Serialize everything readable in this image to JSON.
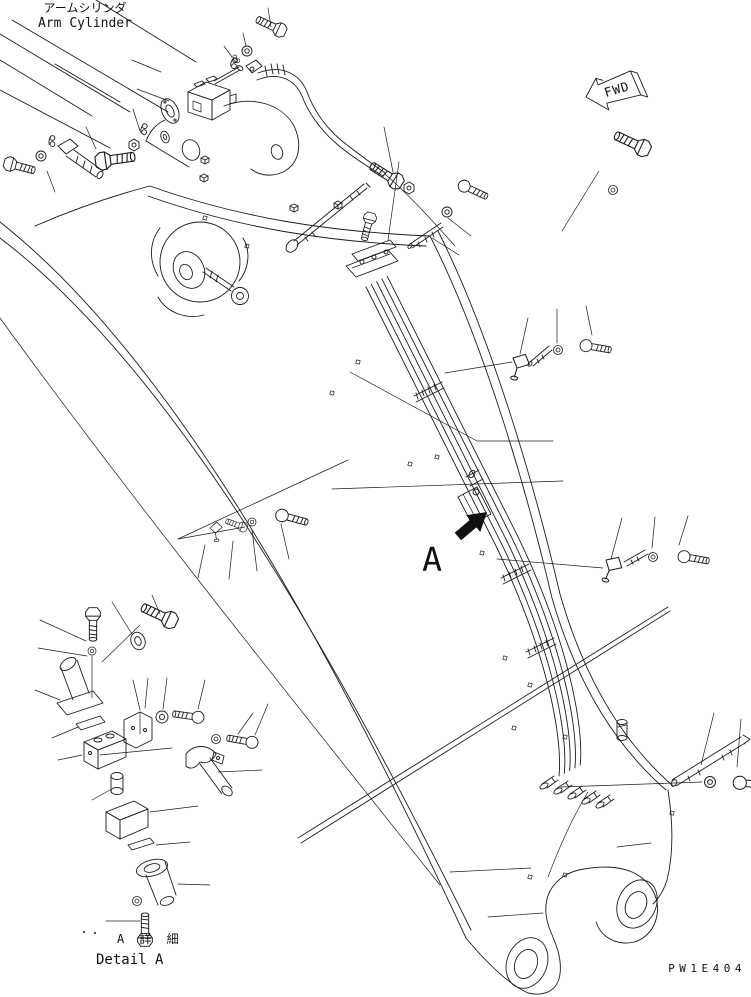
{
  "diagram": {
    "title_jp": "アームシリンダ",
    "title_en": "Arm Cylinder",
    "fwd_label": "FWD",
    "section_marker": "A",
    "detail_title_jp": "A 詳 細",
    "detail_title_en": "Detail A",
    "drawing_code": "PW1E404",
    "colors": {
      "line": "#1c1c1c",
      "background": "#ffffff"
    }
  }
}
